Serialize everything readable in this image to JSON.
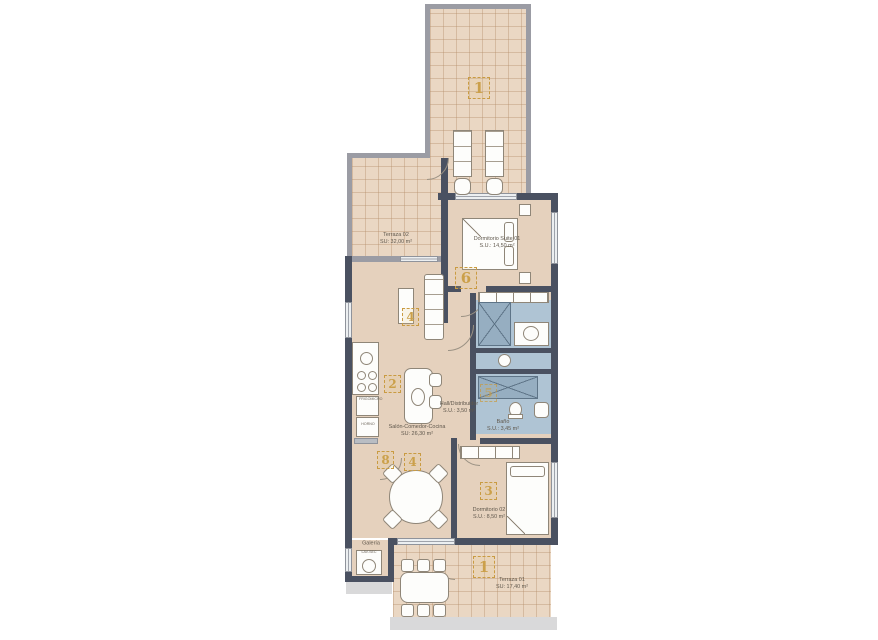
{
  "plan_type": "apartment-floor-plan",
  "rooms": [
    {
      "name": "Terraza 02",
      "area": "SU: 32,00 m²"
    },
    {
      "name": "Dormitorio Suite 01",
      "area": "S.U.: 14,50 m²"
    },
    {
      "name": "Salón-Comedor-Cocina",
      "area": "SU: 26,30 m²"
    },
    {
      "name": "Hall/Distribuidor",
      "area": "S.U.: 3,50 m²"
    },
    {
      "name": "Baño",
      "area": "S.U.: 3,45 m²"
    },
    {
      "name": "Dormitorio 02",
      "area": "S.U.: 8,50 m²"
    },
    {
      "name": "Galería",
      "area": "S.U.: 1,80 m²"
    },
    {
      "name": "Terraza 01",
      "area": "SU: 17,40 m²"
    }
  ],
  "markers": [
    {
      "label": "1"
    },
    {
      "label": "6"
    },
    {
      "label": "4"
    },
    {
      "label": "2"
    },
    {
      "label": "5"
    },
    {
      "label": "8"
    },
    {
      "label": "4"
    },
    {
      "label": "3"
    },
    {
      "label": "1"
    }
  ],
  "appliances": {
    "fridge": "FRIGO",
    "micro": "MICRO",
    "oven": "HORNO",
    "washer": "LAV-SEC"
  },
  "colors": {
    "wall": "#4a5161",
    "terrace_wall": "#9b9ca4",
    "floor": "#e5d1bd",
    "terrace_floor": "#ead7c3",
    "bath_floor": "#afc4d4",
    "shower": "#96aec1",
    "marker_accent": "#c99b42",
    "label_text": "#5f574c",
    "furniture": "#fdfdfb",
    "glazing": "#eceff1",
    "sidewalk": "#d9d9da"
  }
}
